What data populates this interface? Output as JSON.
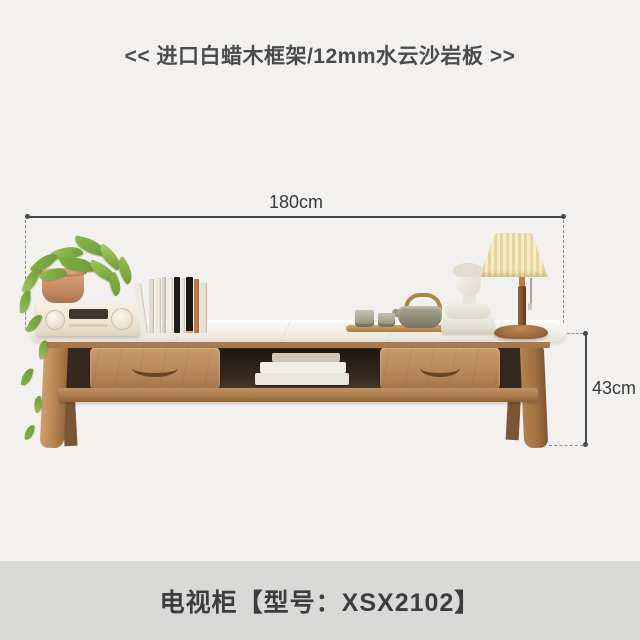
{
  "header": {
    "title": "<< 进口白蜡木框架/12mm水云沙岩板 >>"
  },
  "product": {
    "name": "电视柜",
    "dimensions": {
      "width": "180cm",
      "inner_height_arrow": "↕",
      "inner_height": "40cm",
      "height": "43cm"
    }
  },
  "footer": {
    "model_line": "电视柜【型号：XSX2102】"
  },
  "colors": {
    "background": "#f2f1ef",
    "footer_bar": "#d9d9d7",
    "text": "#3d3d3d",
    "dimension_line": "#4a4a4a",
    "wood": "#b9895a",
    "wood_dark": "#8d6139",
    "stone_top": "#f6f2ec",
    "lamp_shade": "#f3e6bb",
    "plant_green": "#93bf55",
    "pot_terracotta": "#c8916c"
  }
}
